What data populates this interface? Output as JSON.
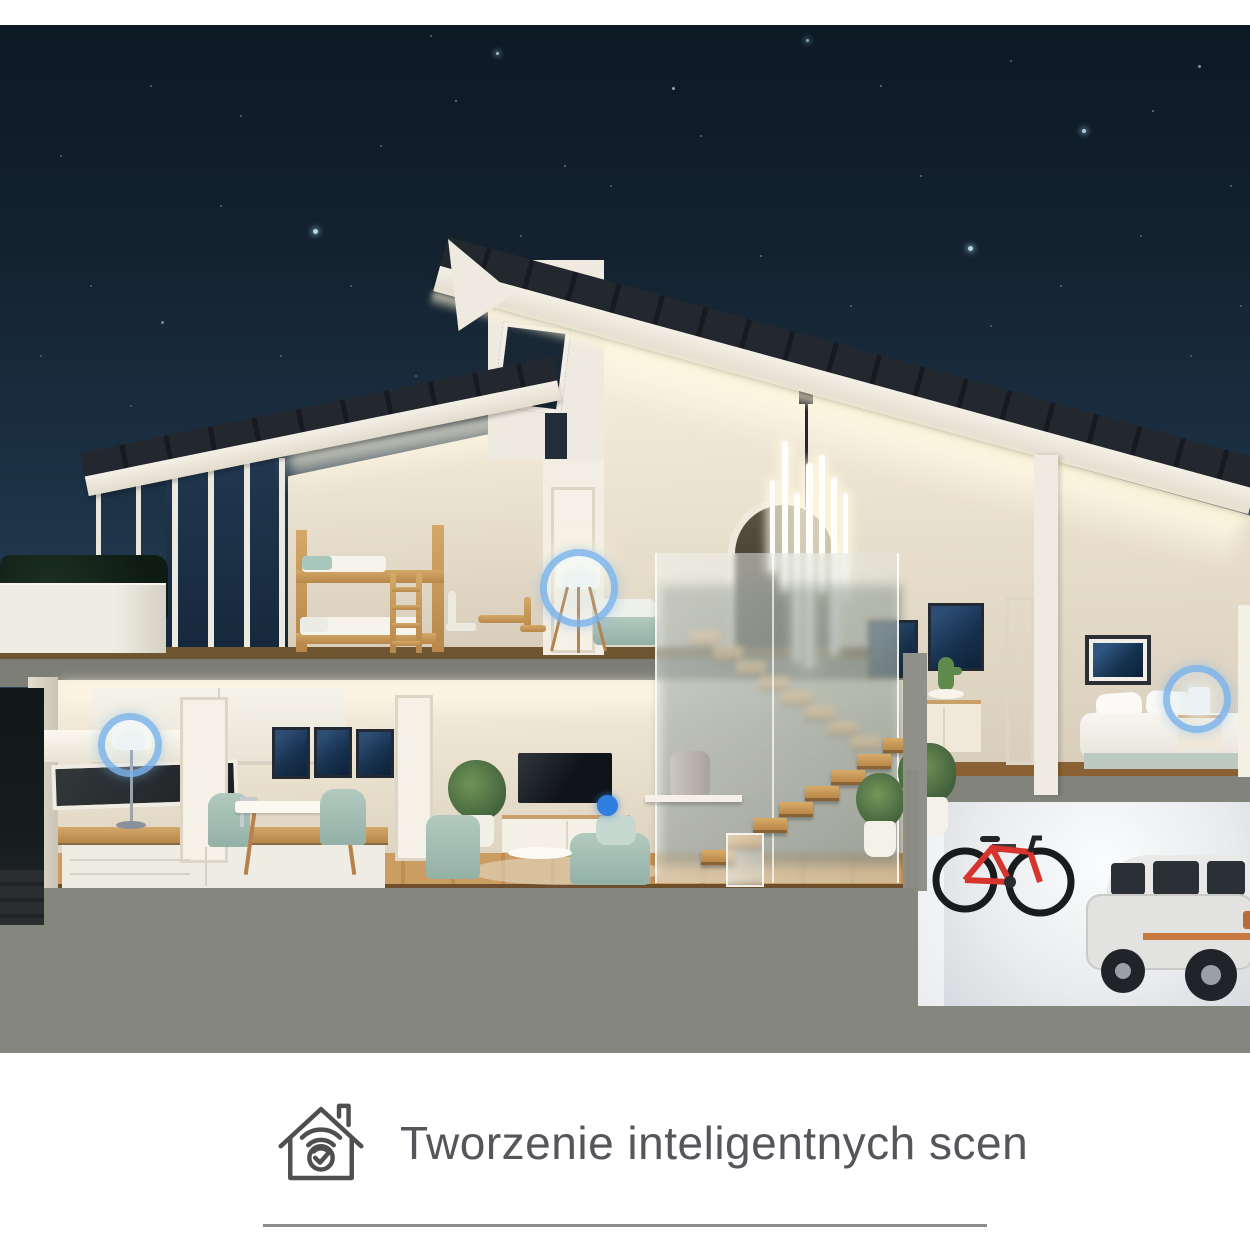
{
  "caption": {
    "icon": "smart-home-scene-icon",
    "text": "Tworzenie inteligentnych scen"
  },
  "divider": {
    "present": true
  },
  "scene": {
    "title": "smart-home-cutaway-night-render",
    "rooms": [
      "kids bunk bedroom",
      "stair landing",
      "master bedroom",
      "hallway",
      "kitchen",
      "dining room",
      "living room",
      "garage"
    ],
    "highlighted_devices": [
      "landing floor lamp",
      "kitchen lamp",
      "bedroom bedside lamp",
      "living room smart dot"
    ],
    "objects": [
      "pendant tube chandelier",
      "smart speaker",
      "wall-mounted red bicycle",
      "silver suv",
      "dining set",
      "tv with media cabinet",
      "bunk bed",
      "double bed",
      "terrace planter"
    ],
    "colors": {
      "sky_top": "#0d1924",
      "sky_mid": "#1d3348",
      "sky_bottom": "#3e5570",
      "roof": "#20252d",
      "warm_wall": "#efe6d3",
      "wood_floor": "#c7995d",
      "foundation": "#85867e",
      "accent_ring": "#7db4eb",
      "accent_dot": "#2e7fe0",
      "bike_red": "#d6342c",
      "caption_text": "#55565b",
      "divider_gray": "#8d8d8d"
    }
  }
}
